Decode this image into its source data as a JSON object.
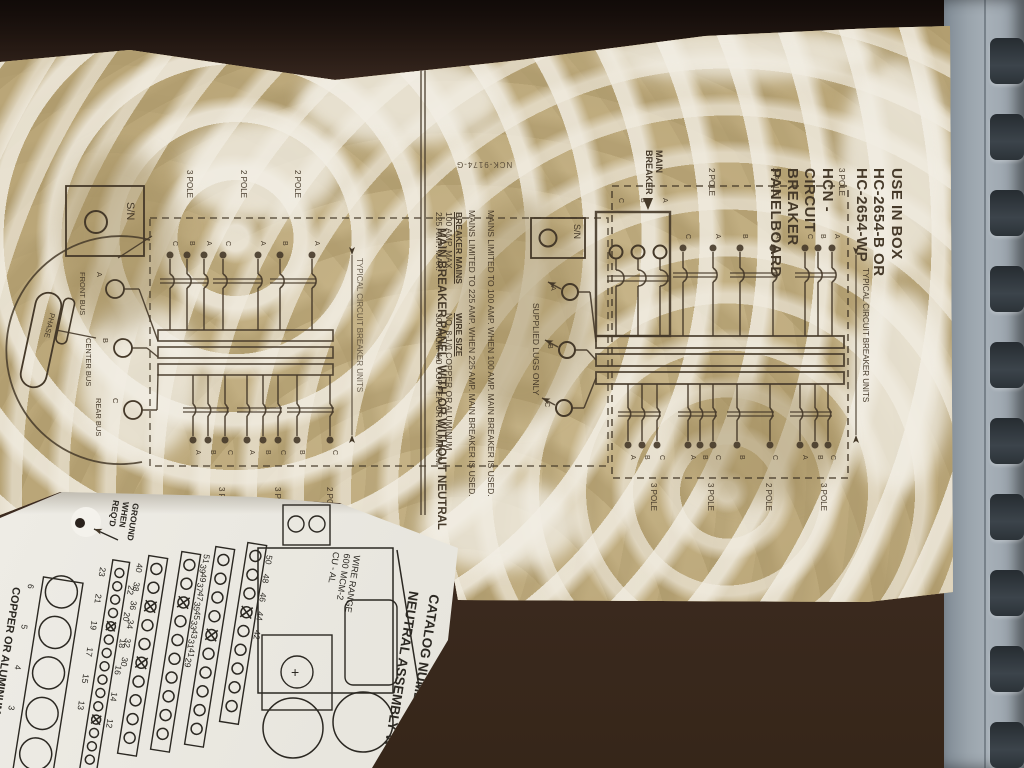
{
  "palette": {
    "panel": "#3b2a21",
    "rail": "#9aa4ac",
    "slot": "#343b41",
    "label_tint": "#c6b488",
    "print": "#453929",
    "white_label": "#ecebe4"
  },
  "main_label": {
    "use_line_1": "USE IN BOX HC-2654-B OR HC-2654-WP",
    "use_line_2": "HCN - CIRCUIT BREAKER PANELBOARD",
    "part_number": "NCK-9174-G",
    "panel_title": "MAIN BREAKER PANEL, WITH OR WITHOUT NEUTRAL",
    "typical_units_note": "TYPICAL CIRCUIT BREAKER UNITS",
    "main_breaker_label": "MAIN BREAKER",
    "sn_label": "S/N",
    "supplied_lugs_note": "SUPPLIED LUGS ONLY",
    "mains_note_100": "MAINS LIMITED TO 100 AMP. WHEN 100 AMP. MAIN BREAKER IS USED.",
    "mains_note_225": "MAINS LIMITED TO 225 AMP. WHEN 225 AMP. MAIN BREAKER IS USED.",
    "breaker_table": {
      "col1_header": "BREAKER MAINS",
      "col2_header": "WIRE SIZE",
      "rows": [
        {
          "mains": "100 AMP. MAX.",
          "wire": "NO. 8-1/0 COPPER OR ALUMINUM"
        },
        {
          "mains": "225 AMP. MAX.",
          "wire": "300 MCM-4/0 COPPER OR ALUMINUM"
        }
      ]
    },
    "right_diagram": {
      "top_pole_labels": [
        "2 POLE",
        "2 POLE",
        "3 POLE"
      ],
      "bottom_pole_labels": [
        "3 POLE",
        "3 POLE",
        "2 POLE",
        "3 POLE"
      ],
      "top_unit_letters": [
        [
          "C",
          "A"
        ],
        [
          "B",
          "A"
        ],
        [
          "C",
          "B",
          "A"
        ]
      ],
      "bottom_unit_letters": [
        [
          "A",
          "B",
          "C"
        ],
        [
          "A",
          "B",
          "C"
        ],
        [
          "B",
          "C"
        ],
        [
          "A",
          "B",
          "C"
        ]
      ],
      "main_breaker_letters": [
        "C",
        "B",
        "A"
      ],
      "feeder_letters": [
        "A",
        "B",
        "C"
      ]
    },
    "left_diagram": {
      "top_pole_labels": [
        "3 POLE",
        "2 POLE",
        "2 POLE"
      ],
      "bottom_pole_labels": [
        "3 POLE",
        "3 POLE",
        "2 POLE"
      ],
      "top_unit_letters": [
        [
          "C",
          "B",
          "A"
        ],
        [
          "C",
          "A"
        ],
        [
          "B",
          "A"
        ]
      ],
      "bottom_unit_letters": [
        [
          "A",
          "B",
          "C"
        ],
        [
          "A",
          "B",
          "C"
        ],
        [
          "B",
          "C"
        ]
      ],
      "bus_labels": [
        {
          "letter": "A",
          "name": "FRONT BUS"
        },
        {
          "letter": "B",
          "name": "CENTER BUS"
        },
        {
          "letter": "C",
          "name": "REAR BUS"
        }
      ],
      "phase_label": "PHASE"
    }
  },
  "neutral_label": {
    "ground_note": "GROUND\nWHEN\nREQ'D",
    "wire_range_note": "WIRE RANGE\n600 MCM-2\nCU - AL",
    "catalog_note": "CATALOG NUMBER\nNEUTRAL ASSEMBLY W",
    "wire_material_note": "COPPER OR ALUMINUM WIRE",
    "plus_mark": "+",
    "strips": [
      {
        "labels": [
          "50",
          "48",
          "46",
          "44",
          "42"
        ],
        "crossed": [
          3
        ]
      },
      {
        "labels": [
          "51",
          "49",
          "47",
          "45",
          "43",
          "41"
        ],
        "crossed": [
          4
        ]
      },
      {
        "labels": [
          "39",
          "37",
          "35",
          "33",
          "31",
          "29"
        ],
        "crossed": [
          2
        ]
      },
      {
        "labels": [
          "40",
          "38",
          "36",
          "34",
          "32",
          "30"
        ],
        "crossed": [
          2,
          5
        ]
      },
      {
        "labels": [
          "23",
          "22",
          "21",
          "20",
          "19",
          "18",
          "17",
          "16",
          "15",
          "14",
          "13",
          "12"
        ],
        "crossed": [
          4,
          11
        ],
        "dual": true
      },
      {
        "labels": [
          "6",
          "5",
          "4",
          "3"
        ],
        "crossed": [],
        "large": true
      }
    ]
  }
}
